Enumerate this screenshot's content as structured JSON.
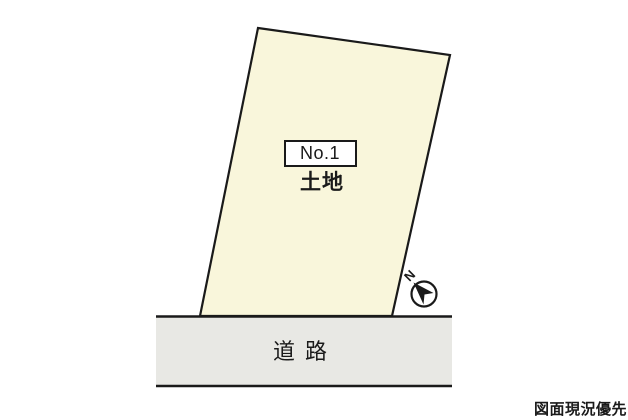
{
  "parcel": {
    "number_label": "No.1",
    "type_label": "土地"
  },
  "road": {
    "label": "道 路"
  },
  "compass": {
    "north_label": "N"
  },
  "footer": {
    "disclaimer": "図面現況優先"
  },
  "colors": {
    "background": "#FFFFFF",
    "parcel_fill": "#F9F6DB",
    "road_fill": "#E8E8E4",
    "label_box_fill": "#FFFFFF",
    "line": "#1A1A1A",
    "text": "#1A1A1A"
  }
}
